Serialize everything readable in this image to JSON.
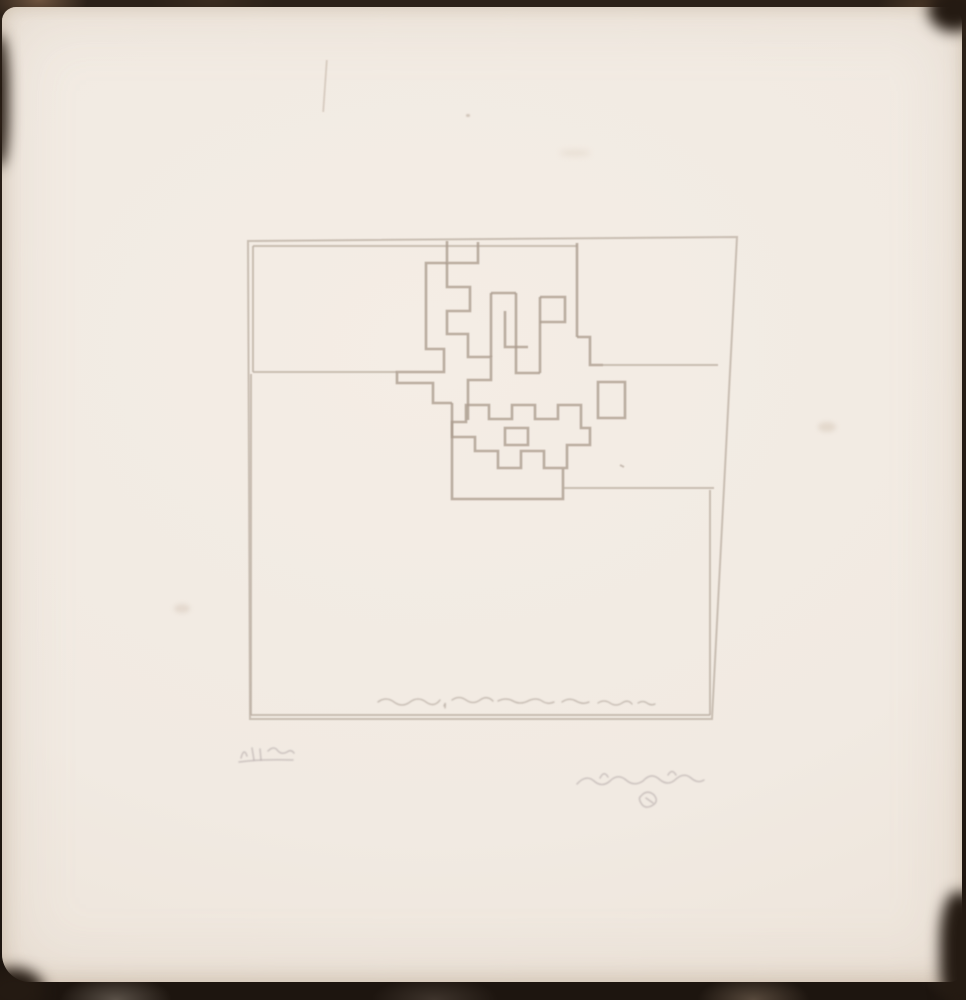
{
  "scene": {
    "type_label": "Photograph of an abstract geometric etching printed on cream wove paper, shown against a dark mottled backdrop, pencil-signed below the platemark",
    "backdrop_color": "#241b14",
    "paper_color": "#f1eae2",
    "plate_line_color": "#b9aca0",
    "meander_line_color": "#ab9c8e",
    "pencil_color": "#aba0a0"
  },
  "etching": {
    "plate_region": {
      "x": 248,
      "y": 237,
      "width": 489,
      "height": 482
    },
    "figures": [
      {
        "name": "plate-outline",
        "cls": "",
        "d": "M248 241 L737 237 L712 719 L250 719 Z"
      },
      {
        "name": "upper-rect-top",
        "cls": "",
        "d": "M253 246 H577"
      },
      {
        "name": "upper-rect-left",
        "cls": "",
        "d": "M253 246 V372"
      },
      {
        "name": "upper-rect-bottom",
        "cls": "",
        "d": "M253 372 H397"
      },
      {
        "name": "upper-rect-right",
        "cls": "meander",
        "d": "M577 243 V337"
      },
      {
        "name": "top-notch-box",
        "cls": "meander",
        "d": "M447 241 V263 H478 V242"
      },
      {
        "name": "meander-chain-left",
        "cls": "meander",
        "d": "M447 263 H426 V349 H444 V372 H397 V383 H433 V403 H452"
      },
      {
        "name": "meander-spiral-left",
        "cls": "meander",
        "d": "M447 263 V287 H470 V311 H447 V334 H468 V357 H491 V380 H468 V420"
      },
      {
        "name": "meander-center-left",
        "cls": "meander",
        "d": "M491 293 V357"
      },
      {
        "name": "meander-center-top",
        "cls": "meander",
        "d": "M491 293 H516"
      },
      {
        "name": "meander-right-stem",
        "cls": "meander",
        "d": "M516 293 V373 H540"
      },
      {
        "name": "meander-right-edge",
        "cls": "meander",
        "d": "M540 297 V373"
      },
      {
        "name": "meander-right-hook",
        "cls": "meander",
        "d": "M540 297 H565 V322 H540"
      },
      {
        "name": "meander-inner-hook",
        "cls": "meander",
        "d": "M505 311 V347 H528"
      },
      {
        "name": "meander-outer-chain",
        "cls": "meander",
        "d": "M577 337 H590 V365 H603"
      },
      {
        "name": "lower-box",
        "cls": "meander",
        "d": "M452 403 V499 H563 V469"
      },
      {
        "name": "crown-outline",
        "cls": "meander",
        "d": "M452 422 H466 V405 H489 V419 H512 V405 H535 V419 H558 V405 H581 V428 H590 V445 H567 V468 H544 V451 H521 V468 H498 V451 H475 V437 H452 Z"
      },
      {
        "name": "crown-inner",
        "cls": "meander",
        "d": "M505 428 H528 V445 H505 Z"
      },
      {
        "name": "right-rect-top",
        "cls": "",
        "d": "M603 365 H718"
      },
      {
        "name": "right-rect-bottom",
        "cls": "",
        "d": "M563 488 H714"
      },
      {
        "name": "right-rect-box",
        "cls": "meander",
        "d": "M598 382 H625 V418 H598 Z"
      },
      {
        "name": "lower-rect-inner-left",
        "cls": "",
        "d": "M251 374 V715"
      },
      {
        "name": "lower-rect-inner-bottom",
        "cls": "",
        "d": "M251 715 H710"
      },
      {
        "name": "lower-rect-inner-right",
        "cls": "",
        "d": "M710 715 V490"
      },
      {
        "name": "stray-dot",
        "cls": "",
        "d": "M620 465 l4 2"
      }
    ]
  },
  "marks": {
    "plate_inscription": {
      "label": "faint etched handwritten inscription along lower edge inside the plate (illegible)",
      "strokes": [
        "M378 702 q8 -6 16 0 t16 0 t16 0 t14 -2",
        "M444 706 q2 -6 1 2",
        "M452 700 q7 -5 14 0 t14 0 t13 1",
        "M498 701 q8 -4 15 0 t15 0 t14 0 t12 1",
        "M562 702 q7 -5 14 -1 t13 1",
        "M598 703 q6 -4 12 0 t12 0 t10 1",
        "M638 703 q5 -3 9 0 t8 1"
      ]
    },
    "edition_mark": {
      "label": "faint pencil edition notation at lower left below the plate (illegible)",
      "strokes": [
        "M241 758 q3 -11 6 -2",
        "M252 748 l2 12",
        "M260 749 l1 11",
        "M268 751 q6 -6 10 0 q4 4 9 1 q4 -3 7 1",
        "M239 762 q22 -3 54 -2"
      ]
    },
    "signature": {
      "label": "faint pencil artist signature at lower right with small circular flourish (illegible)",
      "strokes": [
        "M577 784 q9 -10 17 -3 q8 7 16 0 q8 -8 16 -1 q8 7 17 1 q8 -9 16 -2 q9 8 17 0 q8 -7 15 -1 q7 6 13 2",
        "M600 778 q4 -8 8 -1",
        "M668 775 q4 -7 8 0",
        "M641 796 q6 -7 13 -1 q5 6 -1 10 q-8 5 -12 -2 q-3 -5 0 -7",
        "M646 798 l7 5"
      ]
    }
  }
}
